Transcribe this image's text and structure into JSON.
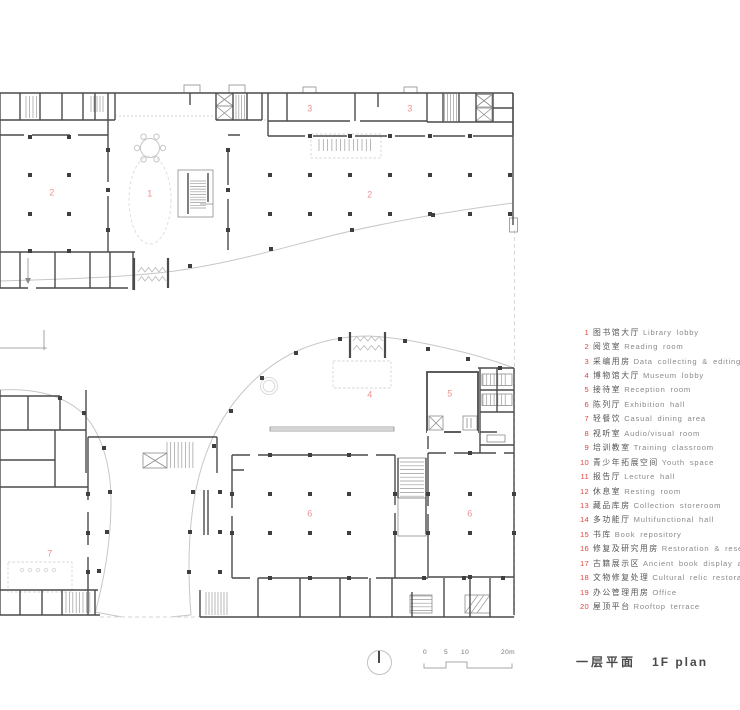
{
  "plan": {
    "label_color": "#f09090",
    "room_labels": [
      {
        "num": "2",
        "x": 52,
        "y": 193
      },
      {
        "num": "1",
        "x": 150,
        "y": 194
      },
      {
        "num": "3",
        "x": 310,
        "y": 109
      },
      {
        "num": "3",
        "x": 410,
        "y": 109
      },
      {
        "num": "2",
        "x": 370,
        "y": 195
      },
      {
        "num": "4",
        "x": 370,
        "y": 395
      },
      {
        "num": "5",
        "x": 450,
        "y": 394
      },
      {
        "num": "6",
        "x": 310,
        "y": 514
      },
      {
        "num": "6",
        "x": 470,
        "y": 514
      },
      {
        "num": "7",
        "x": 50,
        "y": 554
      }
    ]
  },
  "legend": {
    "number_color": "#e2453e",
    "zh_color": "#555353",
    "en_color": "#8c8a8a",
    "items": [
      {
        "num": "1",
        "zh": "图书馆大厅",
        "en": "Library lobby"
      },
      {
        "num": "2",
        "zh": "阅览室",
        "en": "Reading room"
      },
      {
        "num": "3",
        "zh": "采编用房",
        "en": "Data collecting & editing room"
      },
      {
        "num": "4",
        "zh": "博物馆大厅",
        "en": "Museum lobby"
      },
      {
        "num": "5",
        "zh": "接待室",
        "en": "Reception room"
      },
      {
        "num": "6",
        "zh": "陈列厅",
        "en": "Exhibition hall"
      },
      {
        "num": "7",
        "zh": "轻餐饮",
        "en": "Casual dining area"
      },
      {
        "num": "8",
        "zh": "视听室",
        "en": "Audio/visual room"
      },
      {
        "num": "9",
        "zh": "培训教室",
        "en": "Training classroom"
      },
      {
        "num": "10",
        "zh": "青少年拓展空间",
        "en": "Youth space"
      },
      {
        "num": "11",
        "zh": "报告厅",
        "en": "Lecture hall"
      },
      {
        "num": "12",
        "zh": "休息室",
        "en": "Resting room"
      },
      {
        "num": "13",
        "zh": "藏品库房",
        "en": "Collection storeroom"
      },
      {
        "num": "14",
        "zh": "多功能厅",
        "en": "Multifunctional hall"
      },
      {
        "num": "15",
        "zh": "书库",
        "en": "Book repository"
      },
      {
        "num": "16",
        "zh": "修复及研究用房",
        "en": "Restoration & research room"
      },
      {
        "num": "17",
        "zh": "古籍展示区",
        "en": "Ancient book display area"
      },
      {
        "num": "18",
        "zh": "文物修复处理",
        "en": "Cultural relic restoration room"
      },
      {
        "num": "19",
        "zh": "办公管理用房",
        "en": "Office"
      },
      {
        "num": "20",
        "zh": "屋顶平台",
        "en": "Rooftop terrace"
      }
    ]
  },
  "titlebar": {
    "title_zh": "一层平面",
    "title_en": "1F plan",
    "title_color": "#4b4949",
    "scale_ticks": {
      "t0": "0",
      "t1": "5",
      "t2": "10",
      "t3": "20m"
    }
  }
}
